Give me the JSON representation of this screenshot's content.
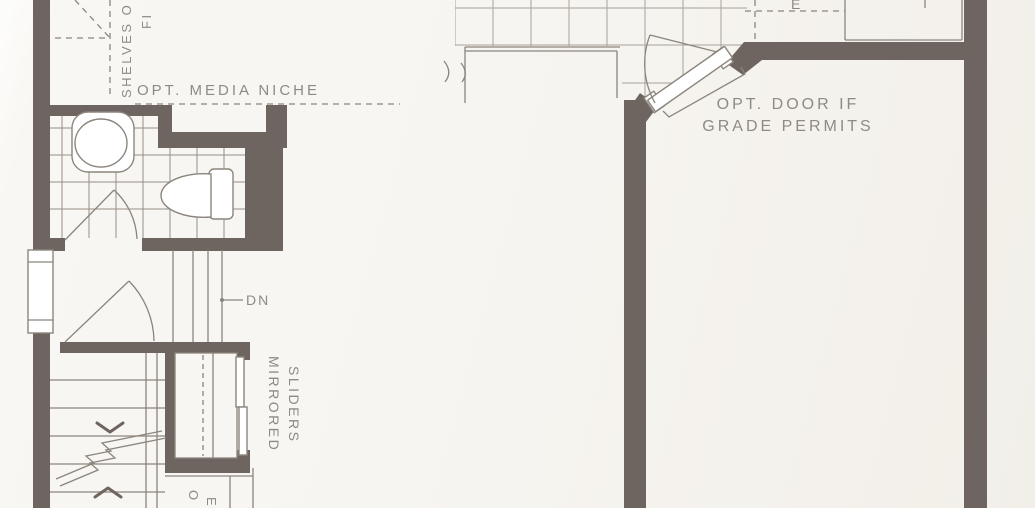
{
  "labels": {
    "media_niche": "OPT. MEDIA NICHE",
    "opt_door_line1": "OPT. DOOR IF",
    "opt_door_line2": "GRADE PERMITS",
    "down": "DN",
    "shelves_fragment": "SHELVES O",
    "fireplace_fragment": "FI",
    "mirrored": "MIRRORED",
    "sliders": "SLIDERS",
    "bottom_fragment_left": "O",
    "bottom_fragment_right": "E",
    "top_fragment": "E"
  },
  "colors": {
    "wall": "#6f6560",
    "line": "#8b857d",
    "tile": "#a8a198",
    "tile_bath": "#958e86",
    "text": "#8f8a84"
  }
}
